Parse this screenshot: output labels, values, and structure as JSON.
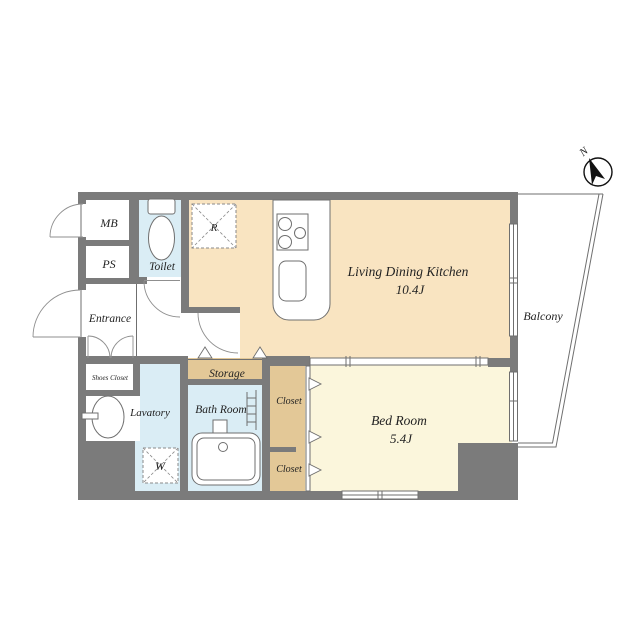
{
  "colors": {
    "wall": "#7b7b7b",
    "ldk": "#f9e4c1",
    "bedroom": "#fbf6dc",
    "wet": "#daedf5",
    "closet": "#e3c897",
    "line": "#6f6f6f"
  },
  "labels": {
    "ldk": "Living Dining Kitchen",
    "ldk_size": "10.4J",
    "bedroom": "Bed Room",
    "bedroom_size": "5.4J",
    "balcony": "Balcony",
    "entrance": "Entrance",
    "toilet": "Toilet",
    "mb": "MB",
    "ps": "PS",
    "shoes_closet": "Shoes Closet",
    "lavatory": "Lavatory",
    "bath": "Bath Room",
    "storage": "Storage",
    "closet_upper": "Closet",
    "closet_lower": "Closet",
    "washer": "W",
    "fridge": "R",
    "compass": "N"
  }
}
